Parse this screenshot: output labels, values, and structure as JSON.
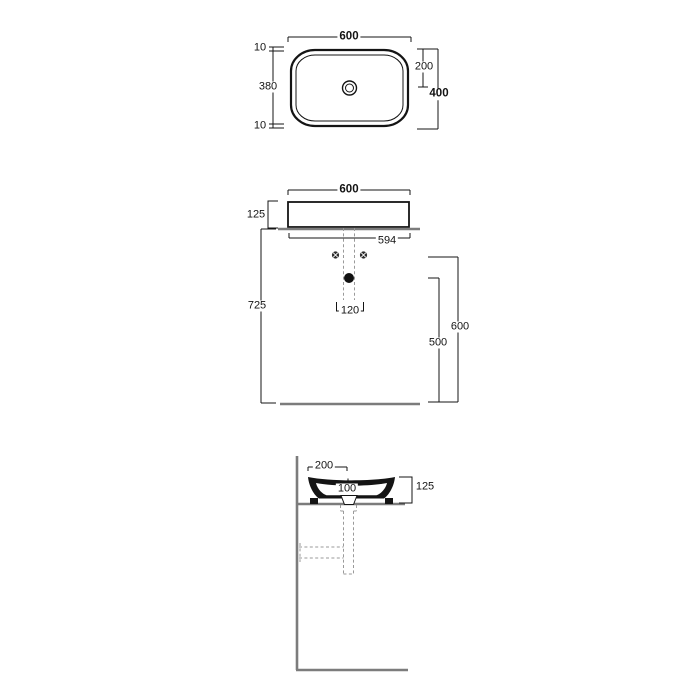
{
  "drawing": {
    "type": "washbasin-technical-drawing",
    "colors": {
      "line": "#141414",
      "structure": "#7c7c7c",
      "dashed": "#9a9a9a"
    },
    "views": {
      "top": {
        "width": "600",
        "rim_top": "10",
        "inner_depth": "380",
        "rim_bottom": "10",
        "drain_offset": "200",
        "overall_depth": "400"
      },
      "front": {
        "width": "600",
        "basin_height": "125",
        "counter_width": "594",
        "floor_to_counter": "725",
        "drain_spacing": "120",
        "outlet_height_a": "600",
        "outlet_height_b": "500"
      },
      "side": {
        "rim_to_drain": "200",
        "drain_center": "100",
        "basin_height": "125"
      }
    }
  }
}
